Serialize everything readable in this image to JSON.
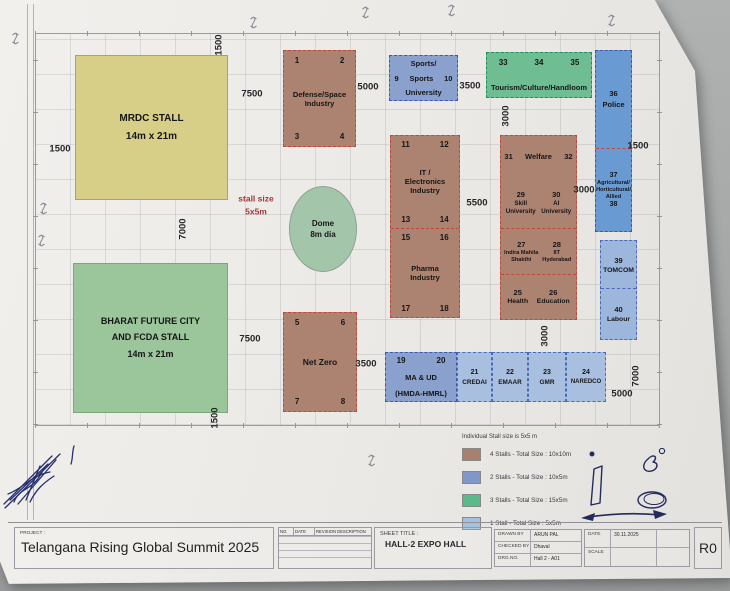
{
  "colors": {
    "background": "#a4a7a6",
    "paper": "#ebe9e5",
    "brown_stall": "#ac8271",
    "blue_stall": "#8aa0cd",
    "light_blue_stall": "#a9bfdf",
    "green_stall": "#6fbe93",
    "yellow_stall": "#d7cf87",
    "big_green_stall": "#9bc59a",
    "dome": "#a3c6ab",
    "red_dash": "#c4473c",
    "ink": "#232a5c"
  },
  "plan": {
    "note": {
      "line1": "stall size",
      "line2": "5x5m"
    },
    "dome": {
      "line1": "Dome",
      "line2": "8m dia"
    },
    "stalls": {
      "mrdc": {
        "name": "MRDC STALL",
        "size": "14m x 21m"
      },
      "bharat": {
        "l1": "BHARAT FUTURE CITY",
        "l2": "AND FCDA STALL",
        "l3": "14m x 21m"
      },
      "defense": {
        "n1": "1",
        "n2": "2",
        "l1": "Defense/Space",
        "l2": "Industry",
        "n3": "3",
        "n4": "4"
      },
      "netzero": {
        "n1": "5",
        "n2": "6",
        "label": "Net Zero",
        "n3": "7",
        "n4": "8"
      },
      "sports": {
        "l1": "Sports/",
        "n1": "9",
        "mid": "Sports",
        "n2": "10",
        "l3": "University"
      },
      "tourism": {
        "n1": "33",
        "n2": "34",
        "n3": "35",
        "label": "Tourism/Culture/Handloom"
      },
      "police": {
        "n": "36",
        "label": "Police"
      },
      "agri": {
        "n1": "37",
        "l1": "Agricultural/",
        "l2": "Horticultural/",
        "l3": "Allied",
        "n2": "38"
      },
      "tomcom": {
        "n": "39",
        "label": "TOMCOM"
      },
      "labour": {
        "n": "40",
        "label": "Labour"
      },
      "it": {
        "n1": "11",
        "n2": "12",
        "l1": "IT /",
        "l2": "Electronics",
        "l3": "Industry",
        "n3": "13",
        "n4": "14"
      },
      "pharma": {
        "n1": "15",
        "n2": "16",
        "l1": "Pharma",
        "l2": "Industry",
        "n3": "17",
        "n4": "18"
      },
      "welfare": {
        "n1": "31",
        "name": "Welfare",
        "n2": "32"
      },
      "skill": {
        "n": "29",
        "name": "Skill University"
      },
      "ai": {
        "n": "30",
        "name": "AI University"
      },
      "indira": {
        "n": "27",
        "name": "Indira Mahila Shakthi"
      },
      "iith": {
        "n": "28",
        "name": "IIT Hyderabad"
      },
      "health": {
        "n": "25",
        "name": "Health"
      },
      "education": {
        "n": "26",
        "name": "Education"
      },
      "maud": {
        "n1": "19",
        "n2": "20",
        "l1": "MA & UD",
        "l2": "(HMDA-HMRL)"
      },
      "credai": {
        "n": "21",
        "name": "CREDAI"
      },
      "emaar": {
        "n": "22",
        "name": "EMAAR"
      },
      "gmr": {
        "n": "23",
        "name": "GMR"
      },
      "naredco": {
        "n": "24",
        "name": "NAREDCO"
      }
    }
  },
  "dims": {
    "top_1500": "1500",
    "top_7500": "7500",
    "top_5000": "5000",
    "top_3500": "3500",
    "left_1500": "1500",
    "left_7000": "7000",
    "tourism_3000": "3000",
    "right_1500": "1500",
    "right_3000": "3000",
    "mid_5500": "5500",
    "bottom_7500": "7500",
    "bottom_3500": "3500",
    "mid_3000": "3000",
    "bl_1500": "1500",
    "br_5000": "5000",
    "br_7000": "7000"
  },
  "legend": {
    "note": "Individual Stall size is 5x5 m",
    "items": [
      {
        "color": "#a8806f",
        "label": "4 Stalls - Total Size : 10x10m"
      },
      {
        "color": "#8297c8",
        "label": "2 Stalls - Total Size : 10x5m"
      },
      {
        "color": "#5cb98b",
        "label": "3 Stalls - Total Size : 15x5m"
      },
      {
        "color": "#a6c1de",
        "label": "1 Stall - Total Size : 5x5m"
      }
    ]
  },
  "sheet": {
    "project_label": "PROJECT :",
    "project_name": "Telangana Rising Global Summit 2025",
    "rev": {
      "no": "NO.",
      "date": "DATE",
      "desc": "REVISION DESCRIPTION"
    },
    "sheet_title_label": "SHEET TITLE :",
    "sheet_title": "HALL-2 EXPO HALL",
    "fields": {
      "drawn_by_label": "DRAWN BY",
      "drawn_by": "ARUN PAL",
      "checked_by_label": "CHECKED BY",
      "checked_by": "Dhaval",
      "drg_no_label": "DRG.NO.",
      "drg_no": "Hall 2 - A01",
      "date_label": "DATE",
      "date_value": "30.11.2025",
      "scale_label": "SCALE",
      "scale_value": "",
      "revision_no": "R0"
    }
  }
}
